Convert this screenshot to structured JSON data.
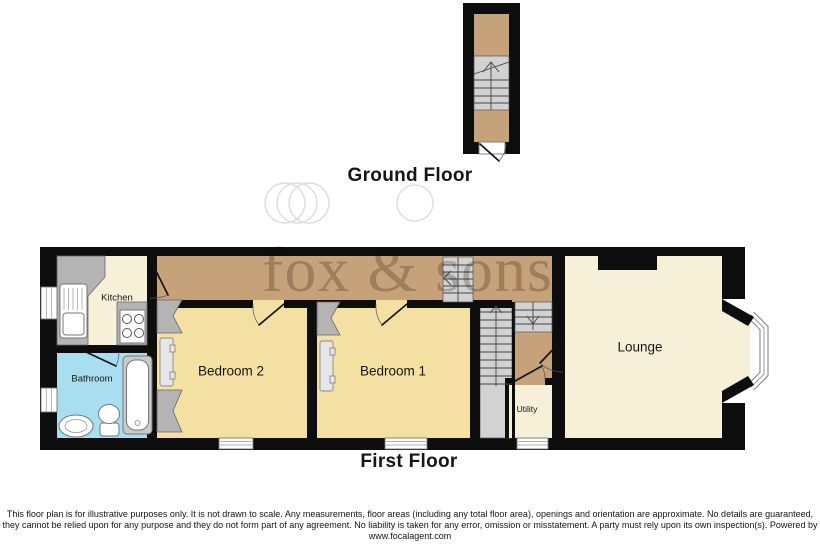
{
  "labels": {
    "ground_floor": "Ground Floor",
    "first_floor": "First Floor"
  },
  "rooms": {
    "kitchen": "Kitchen",
    "bathroom": "Bathroom",
    "bedroom2": "Bedroom 2",
    "bedroom1": "Bedroom 1",
    "utility": "Utility",
    "lounge": "Lounge"
  },
  "watermark": {
    "text": "fox & sons"
  },
  "disclaimer": {
    "line1": "This floor plan is for illustrative purposes only. It is not drawn to scale. Any measurements, floor areas (including any total floor area), openings and orientation are approximate. No details are guaranteed,",
    "line2": "they cannot be relied upon for any purpose and they do not form part of any agreement. No liability is taken for any error, omission or misstatement. A party must rely upon its own inspection(s). Powered by",
    "line3": "www.focalagent.com"
  },
  "colors": {
    "wall": "#0d0d0d",
    "hall_floor": "#c6a27b",
    "bedroom_floor": "#f5e0a3",
    "cream_floor": "#f6f0d8",
    "bathroom_floor": "#a9def0",
    "stairs": "#d2d2d2",
    "counter": "#b4b4b4",
    "watermark_text": "#cdc6bf",
    "watermark_circle": "#dedede"
  }
}
